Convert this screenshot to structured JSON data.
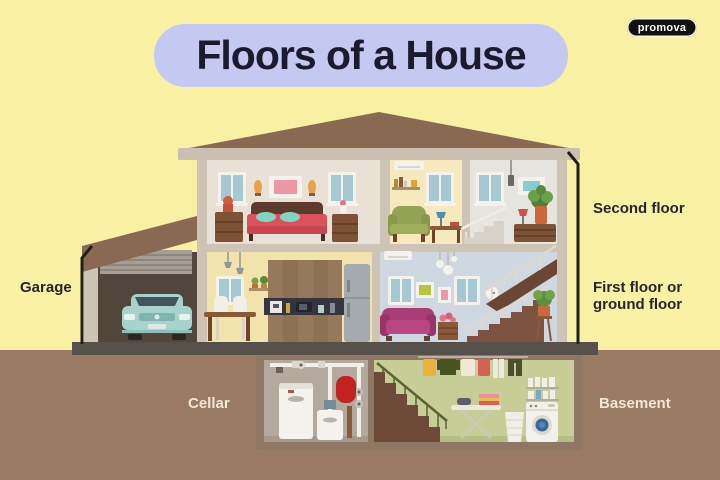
{
  "title": "Floors of a House",
  "brand": "promova",
  "labels": {
    "garage": "Garage",
    "second_floor": "Second floor",
    "first_floor": "First floor or ground floor",
    "cellar": "Cellar",
    "basement": "Basement"
  },
  "diagram": {
    "type": "house-cross-section",
    "floors": [
      {
        "label": "Second floor",
        "rooms": [
          "bedroom",
          "study",
          "stair landing"
        ]
      },
      {
        "label": "First floor or ground floor",
        "rooms": [
          "garage",
          "kitchen",
          "living room with staircase"
        ]
      },
      {
        "label": "Underground",
        "rooms": [
          "cellar with boiler and pipes",
          "basement with laundry"
        ]
      }
    ]
  },
  "colors": {
    "background": "#f8f1a3",
    "ground": "#9a7a62",
    "foundation": "#56504a",
    "roof": "#8a6952",
    "trim": "#cdc4b6",
    "bedroom_wall": "#e9e1d5",
    "study_wall": "#f6e9bd",
    "landing_wall": "#e6e4df",
    "kitchen_wall": "#f0e3ac",
    "living_wall": "#cfd8e0",
    "garage_interior": "#52453c",
    "cellar_wall": "#b3a99c",
    "basement_wall": "#c6cd96",
    "title_bg": "#c5c9f2",
    "title_text": "#1b1a2e",
    "label_dark": "#26252e",
    "label_light": "#f3e7d7",
    "brand_bg": "#121212",
    "brand_text": "#ffffff",
    "car": "#a8d2cc",
    "sofa": "#a93e74",
    "bed": "#da525b"
  }
}
